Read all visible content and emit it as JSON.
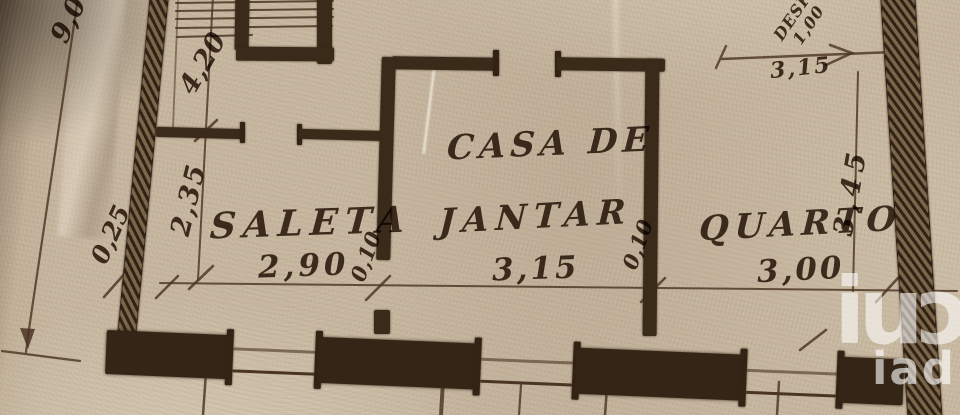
{
  "plan": {
    "rooms": [
      {
        "name": "SALETA",
        "width_m": "2,90"
      },
      {
        "name_line1": "CASA DE",
        "name_line2": "JANTAR",
        "width_m": "3,15"
      },
      {
        "name": "QUARTO",
        "width_m": "3,00"
      }
    ],
    "annex": {
      "name": "DESP.",
      "width_m": "1,00",
      "front_dim": "3,15"
    },
    "dims": {
      "left_total": "9,00",
      "stair_depth": "4,20",
      "saleta_depth": "2,35",
      "left_offset": "0,25",
      "wall_thickness_1": "0,10",
      "wall_thickness_2": "0,10",
      "right_depth": "3,45"
    }
  },
  "watermark": {
    "brand": "iad",
    "logo_glyphs": "iuɔ"
  },
  "colors": {
    "paper": "#c7b7a0",
    "ink": "#3e2c1c",
    "watermark": "#ffffff"
  }
}
